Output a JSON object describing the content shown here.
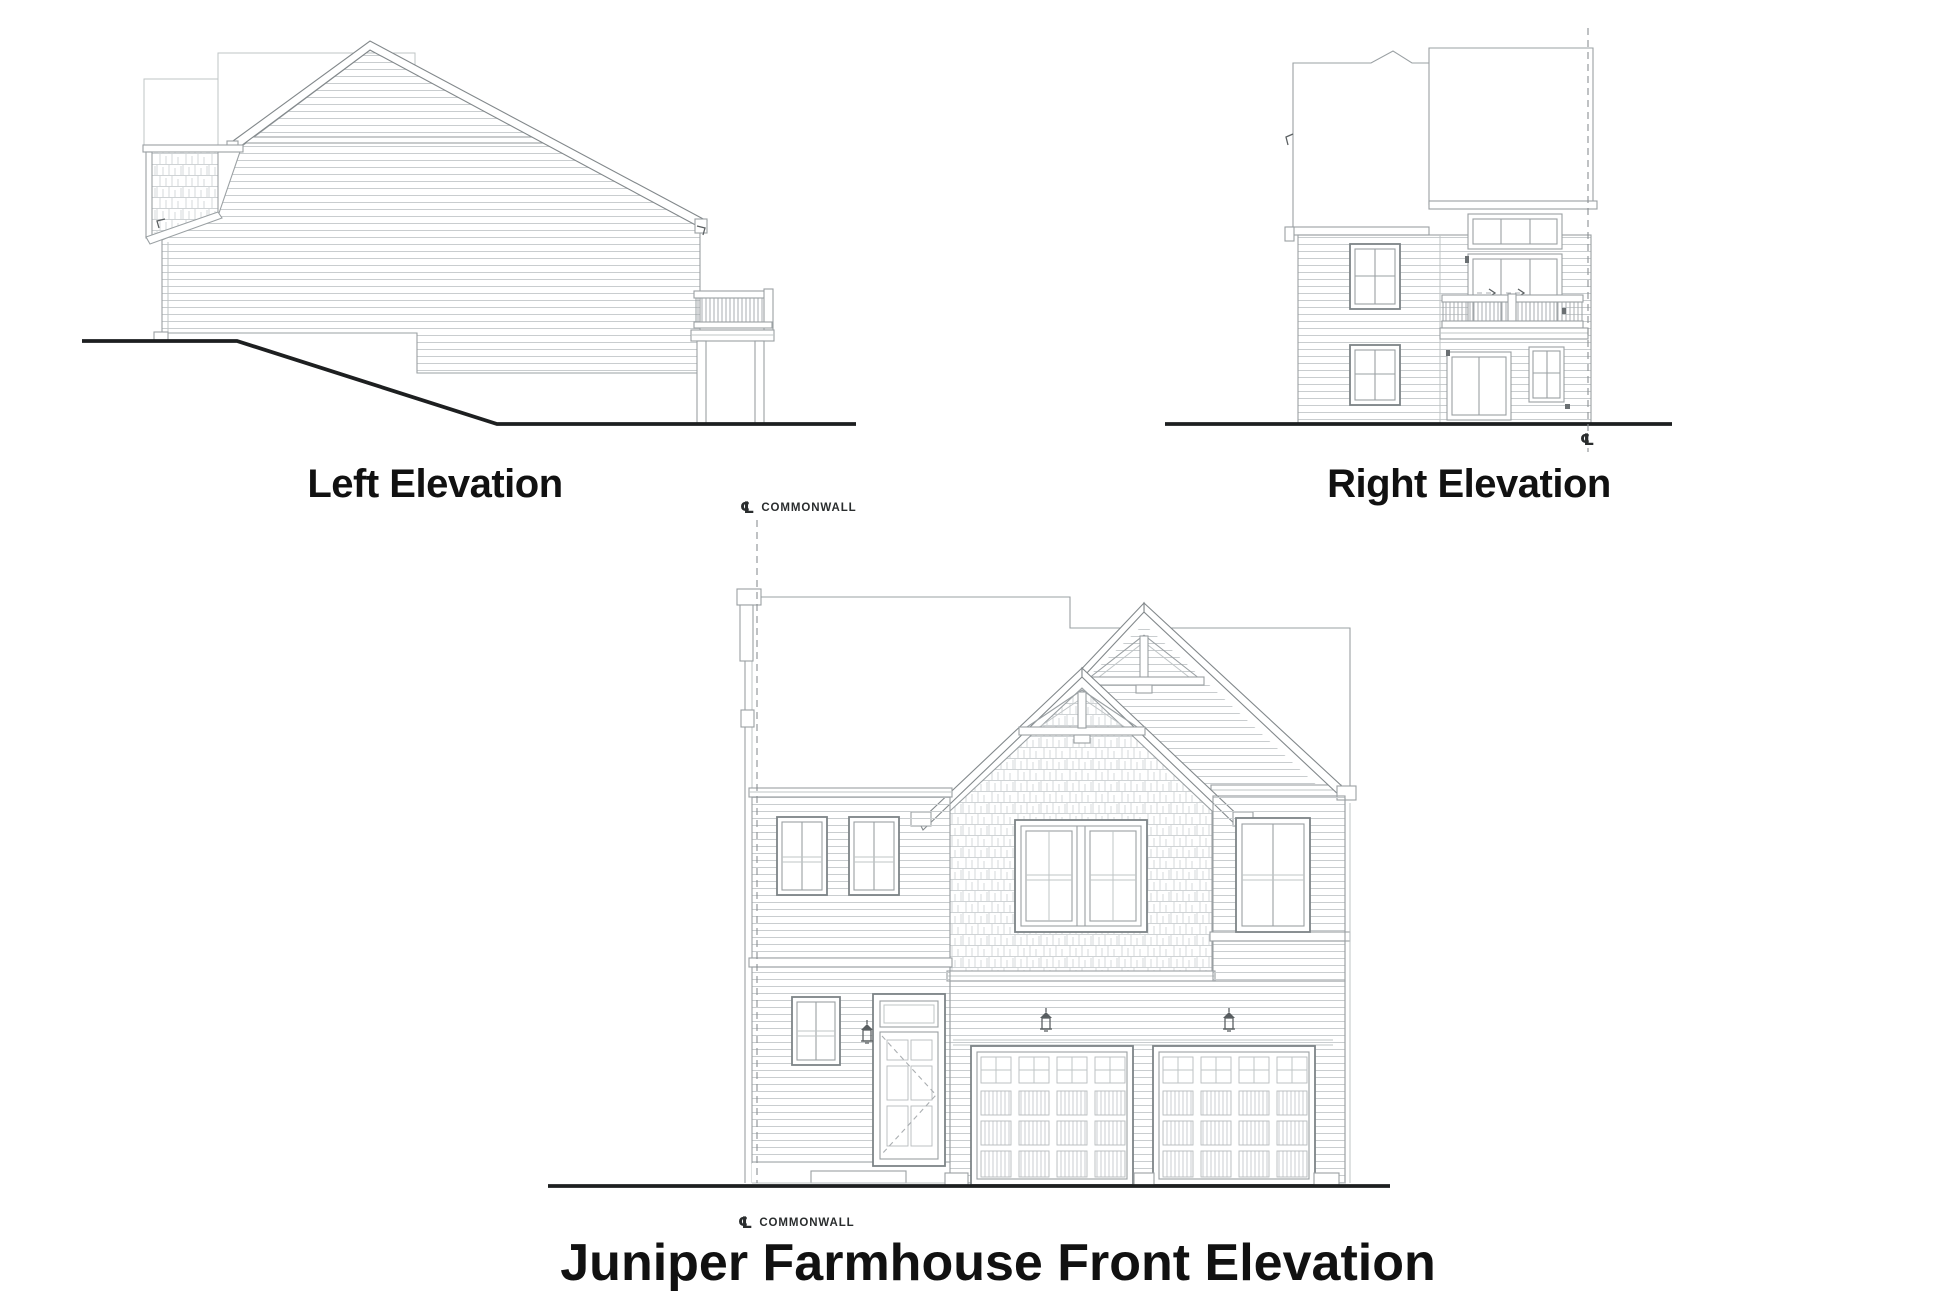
{
  "page": {
    "background": "#ffffff"
  },
  "elevations": {
    "left": {
      "title": "Left Elevation"
    },
    "right": {
      "title": "Right Elevation"
    },
    "front": {
      "title": "Juniper Farmhouse Front Elevation"
    }
  },
  "annotations": {
    "centerline_symbol": "℄",
    "commonwall": "COMMONWALL"
  },
  "colors": {
    "ink": "#111111",
    "ground_line": "#1d1f20",
    "drawing_line": "#9aa0a3"
  }
}
